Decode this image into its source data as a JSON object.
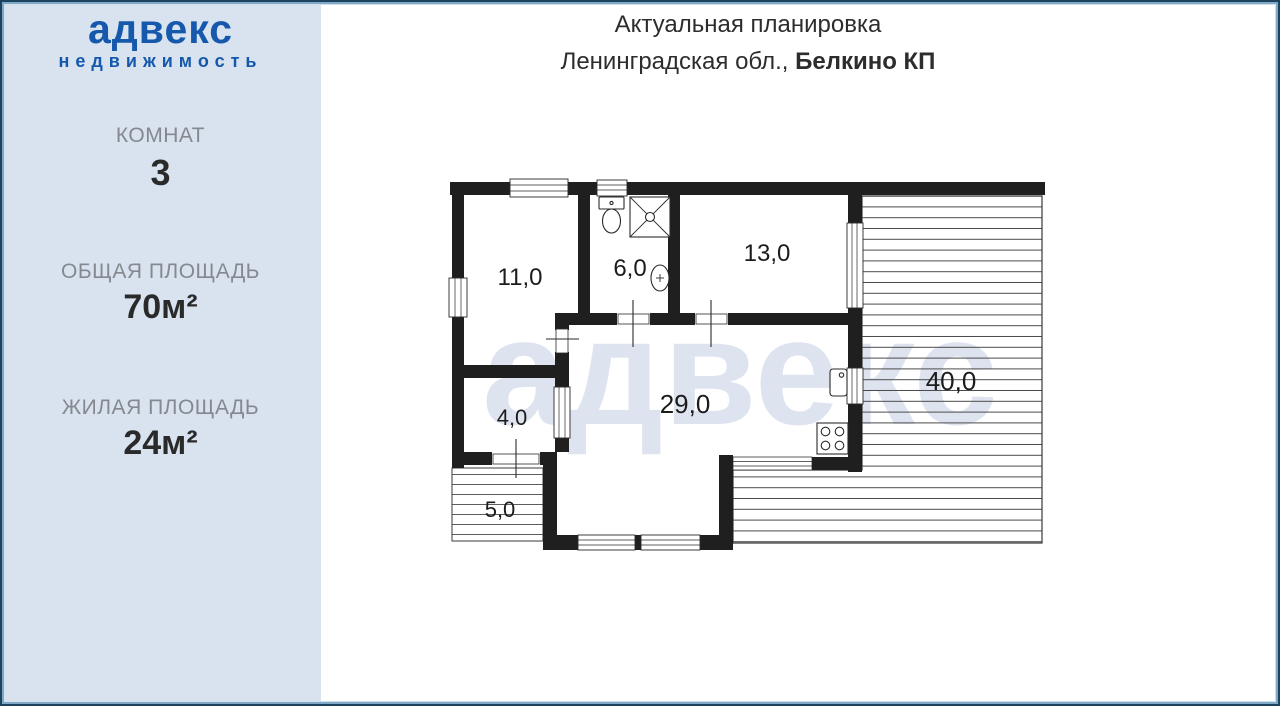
{
  "brand": {
    "name": "адвекс",
    "tagline": "недвижимость"
  },
  "sidebar": {
    "stats": [
      {
        "label": "КОМНАТ",
        "value": "3"
      },
      {
        "label": "ОБЩАЯ ПЛОЩАДЬ",
        "value": "70м²"
      },
      {
        "label": "ЖИЛАЯ ПЛОЩАДЬ",
        "value": "24м²"
      }
    ]
  },
  "header": {
    "title": "Актуальная планировка",
    "location": "Ленинградская обл., ",
    "location_bold": "Белкино КП"
  },
  "watermark": "адвекс",
  "floorplan": {
    "unit": "м²",
    "rooms": [
      {
        "id": "room-11",
        "area": "11,0"
      },
      {
        "id": "bathroom-6",
        "area": "6,0"
      },
      {
        "id": "room-13",
        "area": "13,0"
      },
      {
        "id": "hall-4",
        "area": "4,0"
      },
      {
        "id": "living-29",
        "area": "29,0"
      },
      {
        "id": "terrace-40",
        "area": "40,0"
      },
      {
        "id": "porch-5",
        "area": "5,0"
      }
    ],
    "fixtures": [
      "toilet-icon",
      "shower-icon",
      "sink-icon",
      "kitchen-sink-icon",
      "stove-icon"
    ]
  },
  "colors": {
    "sidebar_bg": "#d8e3ef",
    "brand_blue": "#1558ac",
    "label_gray": "#85898f",
    "text_dark": "#2a2a2a",
    "wall": "#1f1f1f",
    "watermark": "#dee3f0",
    "frame_navy": "#1d445f",
    "frame_blue": "#7fa9c6"
  }
}
